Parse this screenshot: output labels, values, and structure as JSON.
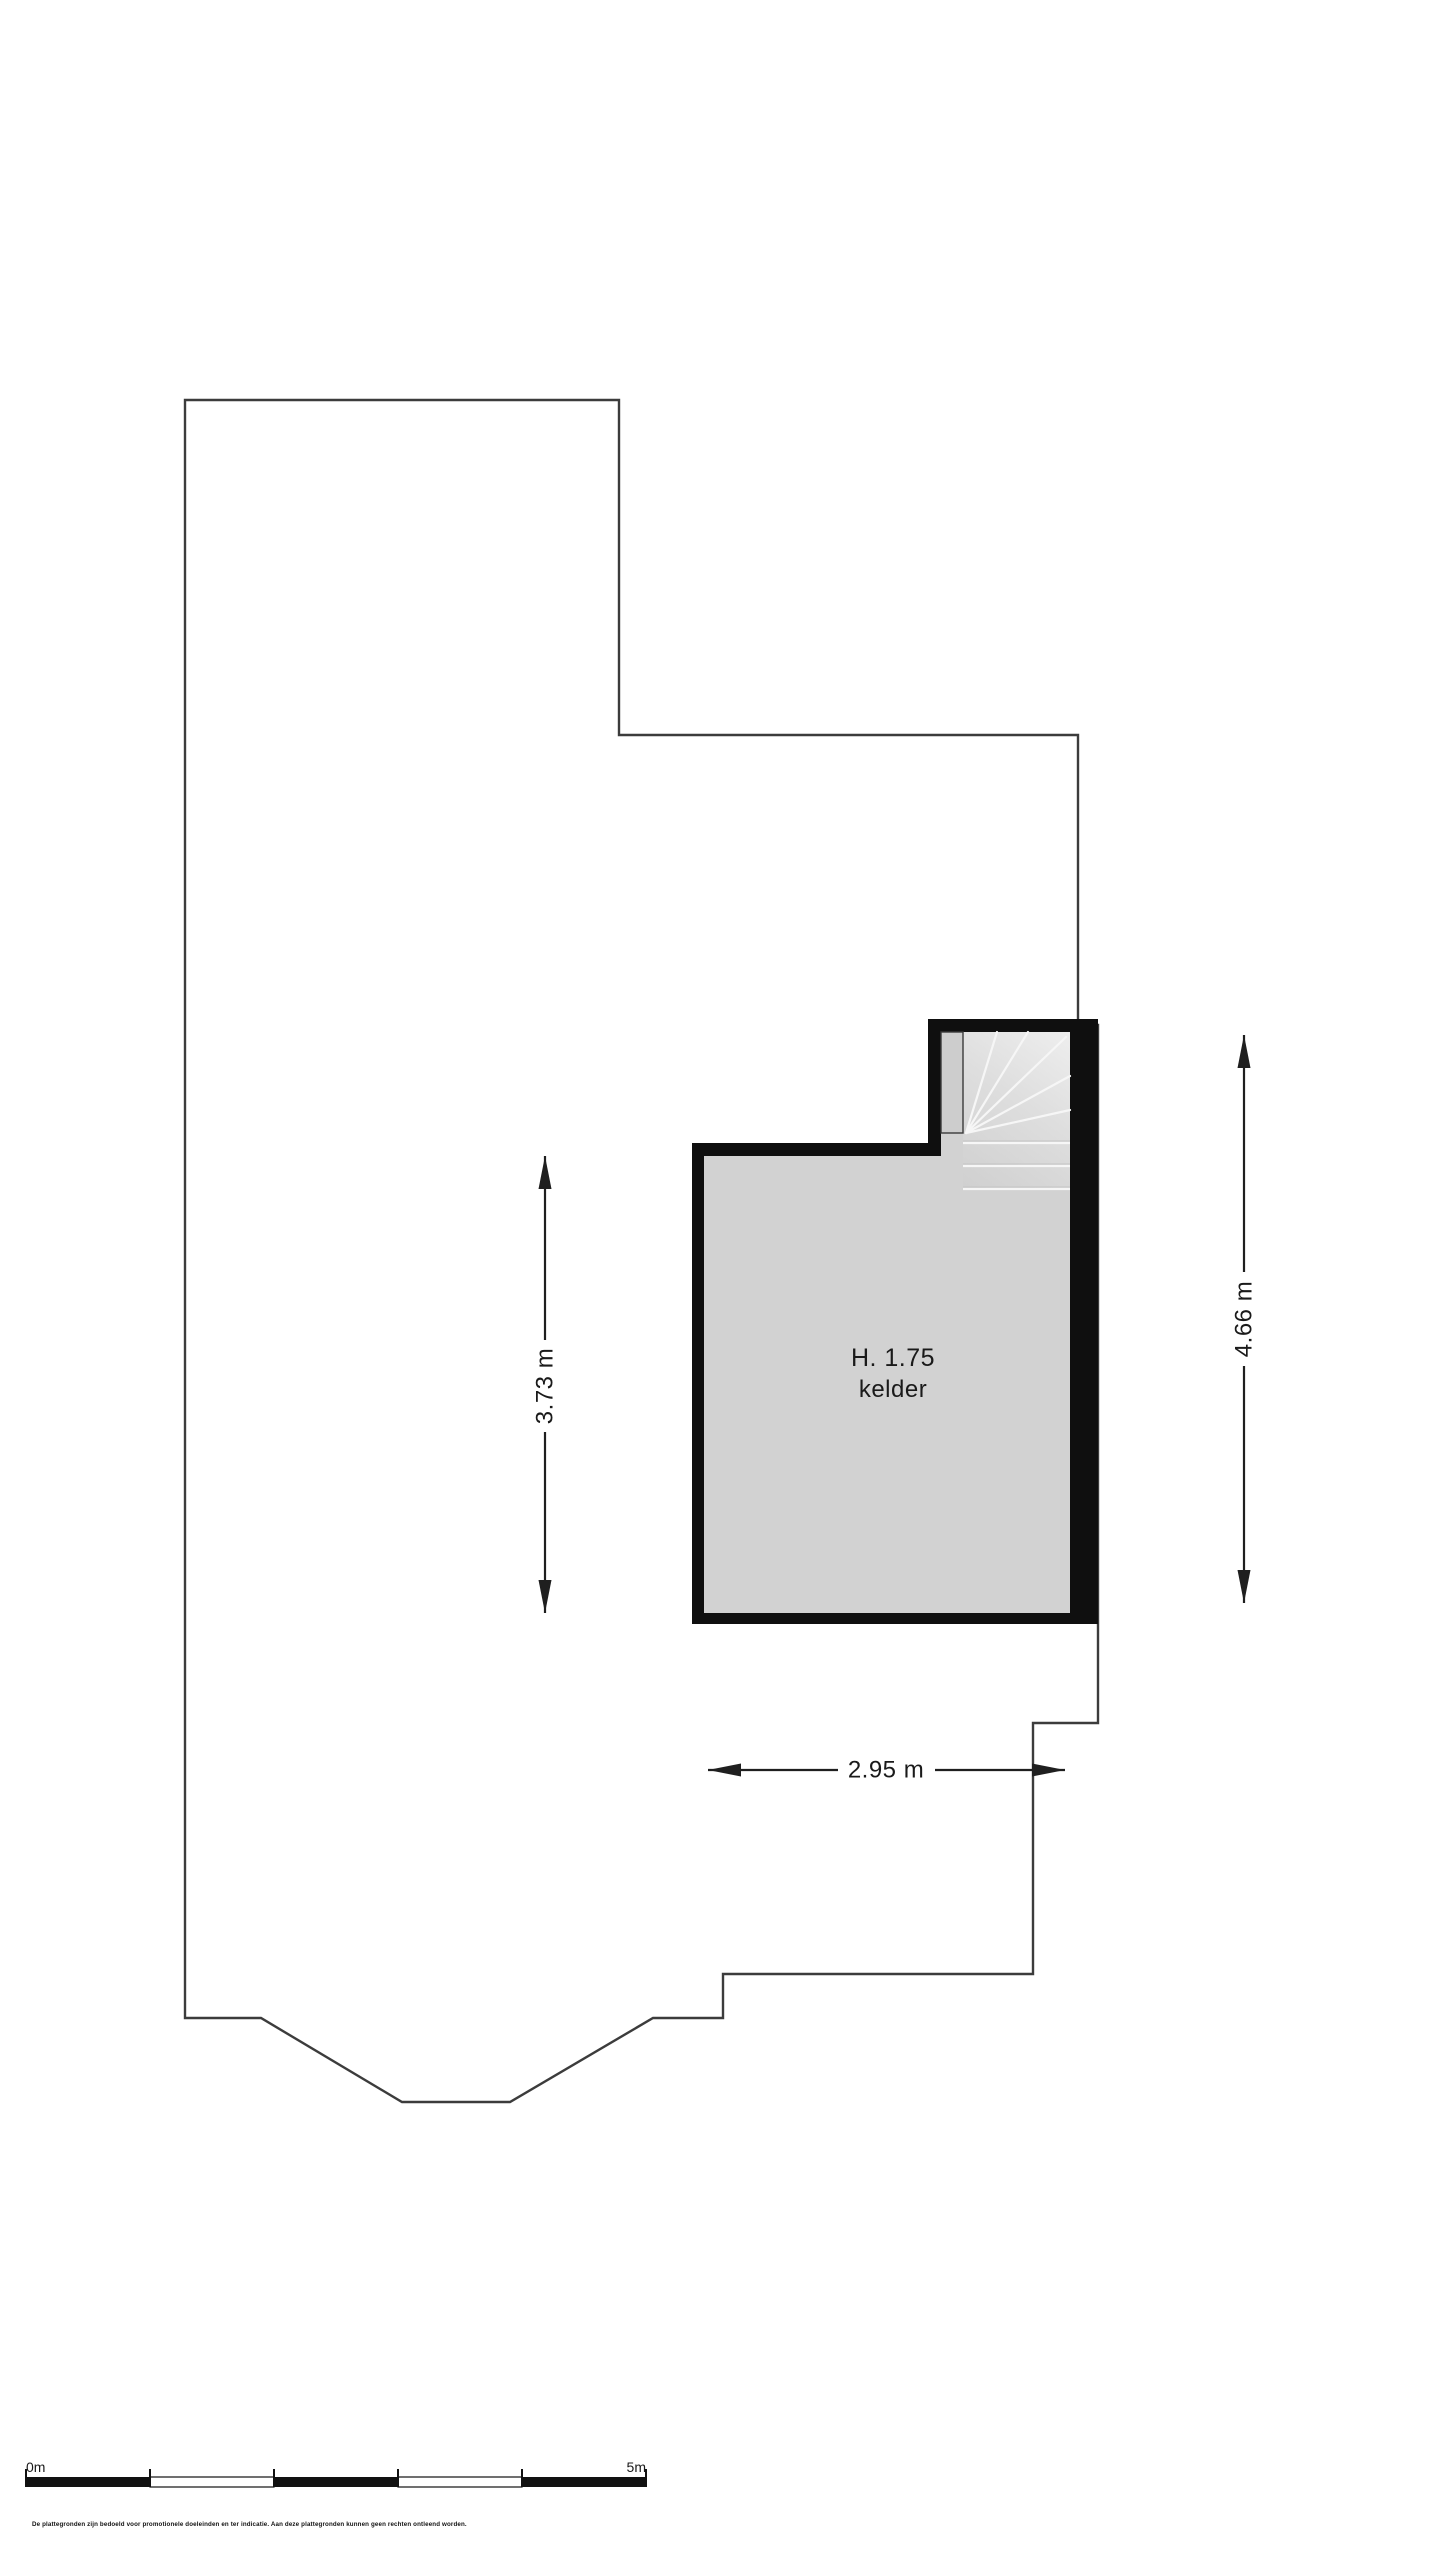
{
  "room": {
    "height_label": "H. 1.75",
    "name": "kelder"
  },
  "dimensions": {
    "inner_depth_label": "3.73 m",
    "total_depth_label": "4.66 m",
    "inner_width_label": "2.95 m"
  },
  "scale_bar": {
    "start_label": "0m",
    "end_label": "5m"
  },
  "disclaimer": "De plattegronden zijn bedoeld voor promotionele doeleinden en ter indicatie. Aan deze plattegronden kunnen geen rechten ontleend worden.",
  "colors": {
    "wall": "#0f0f0f",
    "floor": "#d2d2d2",
    "landing": "#cdcdcd",
    "outline": "#3c3c3c",
    "dimension": "#1f1f1f",
    "tread_line": "#f6f6f6"
  }
}
